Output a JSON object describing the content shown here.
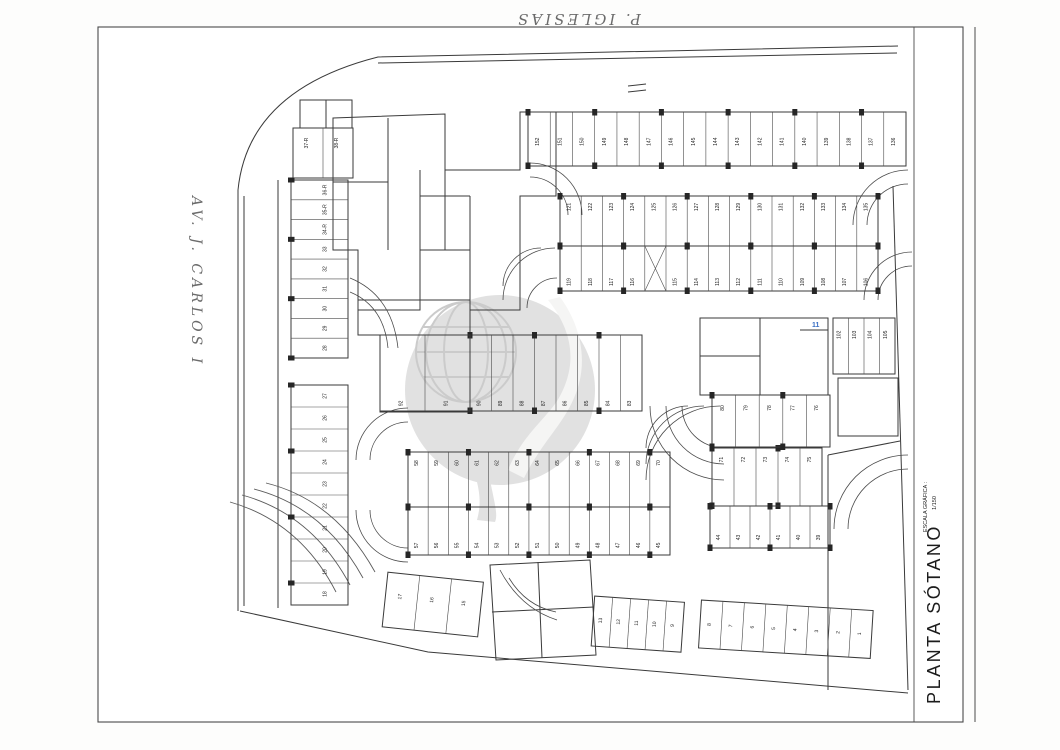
{
  "annotations": {
    "top_street": "P. IGLESIAS",
    "left_street": "AV. J. CARLOS I",
    "blue_note": "11",
    "blue_note_color": "#3a6fc4"
  },
  "title_block": {
    "title": "PLANTA SÓTANO",
    "scale_caption": "ESCALA GRÁFICA :",
    "scale_ratio": "1/150",
    "scale_ticks": [
      "0",
      "1",
      "2",
      "3",
      "4",
      "5m"
    ],
    "scale_end": "10m"
  },
  "watermark": {
    "present": true,
    "style": "globe-swoosh-circle",
    "color": "#d9d9d9"
  },
  "colors": {
    "ink": "#3a3a3a",
    "cyan_hatch": "#63b7cc",
    "pink_marker": "#d4748c",
    "tan": "#c9b896",
    "ramp_fill": "#262626"
  },
  "plan": {
    "rows": [
      {
        "name": "row-136-152",
        "x": 528,
        "y": 112,
        "w": 378,
        "h": 54,
        "numY": 0.55,
        "cols": true,
        "nums": [
          "152",
          "151",
          "150",
          "149",
          "148",
          "147",
          "146",
          "145",
          "144",
          "143",
          "142",
          "141",
          "140",
          "139",
          "138",
          "137",
          "136"
        ]
      },
      {
        "name": "row-121-135",
        "x": 560,
        "y": 196,
        "w": 318,
        "h": 50,
        "numY": 0.22,
        "cols": true,
        "nums": [
          "121",
          "122",
          "123",
          "124",
          "125",
          "126",
          "127",
          "128",
          "129",
          "130",
          "131",
          "132",
          "133",
          "134",
          "135"
        ]
      },
      {
        "name": "row-106-119",
        "x": 560,
        "y": 246,
        "w": 318,
        "h": 45,
        "numY": 0.8,
        "cols": true,
        "nums": [
          "119",
          "118",
          "117",
          "116",
          "X",
          "115",
          "114",
          "113",
          "112",
          "111",
          "110",
          "109",
          "108",
          "107",
          "106"
        ]
      },
      {
        "name": "row-58-70",
        "x": 408,
        "y": 452,
        "w": 262,
        "h": 55,
        "numY": 0.2,
        "cols": true,
        "nums": [
          "58",
          "59",
          "60",
          "61",
          "62",
          "63",
          "64",
          "65",
          "66",
          "67",
          "68",
          "69",
          "70"
        ]
      },
      {
        "name": "row-45-57",
        "x": 408,
        "y": 507,
        "w": 262,
        "h": 48,
        "numY": 0.8,
        "cols": true,
        "nums": [
          "57",
          "56",
          "55",
          "54",
          "53",
          "52",
          "51",
          "50",
          "49",
          "48",
          "47",
          "46",
          "45"
        ]
      },
      {
        "name": "row-71-75",
        "x": 712,
        "y": 448,
        "w": 110,
        "h": 58,
        "numY": 0.2,
        "cols": true,
        "nums": [
          "71",
          "72",
          "73",
          "74",
          "75"
        ]
      },
      {
        "name": "row-39-44",
        "x": 710,
        "y": 506,
        "w": 120,
        "h": 42,
        "numY": 0.75,
        "cols": true,
        "nums": [
          "44",
          "43",
          "42",
          "41",
          "40",
          "39"
        ]
      },
      {
        "name": "row-83-90",
        "x": 470,
        "y": 335,
        "w": 172,
        "h": 76,
        "numY": 0.9,
        "cols": true,
        "nums": [
          "90",
          "89",
          "88",
          "87",
          "86",
          "85",
          "84",
          "83"
        ]
      },
      {
        "name": "row-91-92-pmr",
        "x": 380,
        "y": 335,
        "w": 90,
        "h": 76,
        "numY": 0.9,
        "cols": false,
        "nums": [
          "92",
          "91"
        ]
      },
      {
        "name": "row-76-80",
        "x": 712,
        "y": 395,
        "w": 118,
        "h": 52,
        "numY": 0.25,
        "cols": true,
        "nums": [
          "80",
          "79",
          "78",
          "77",
          "76"
        ]
      },
      {
        "name": "rooms-102-105",
        "x": 833,
        "y": 318,
        "w": 62,
        "h": 56,
        "numY": 0.3,
        "cols": false,
        "nums": [
          "102",
          "103",
          "104",
          "105"
        ]
      },
      {
        "name": "rooms-37R-38R",
        "x": 293,
        "y": 128,
        "w": 60,
        "h": 50,
        "numY": 0.3,
        "cols": false,
        "nums": [
          "37-R",
          "38-R"
        ]
      },
      {
        "name": "col-28-36R",
        "x": 291,
        "y": 180,
        "w": 57,
        "h": 178,
        "vert": true,
        "numX": 0.62,
        "cols": true,
        "nums": [
          "36-R",
          "35-R",
          "34-R",
          "33",
          "32",
          "31",
          "30",
          "29",
          "28"
        ]
      },
      {
        "name": "col-18-27",
        "x": 291,
        "y": 385,
        "w": 57,
        "h": 220,
        "vert": true,
        "numX": 0.62,
        "cols": true,
        "nums": [
          "27",
          "26",
          "25",
          "24",
          "23",
          "22",
          "21",
          "20",
          "19",
          "18"
        ]
      },
      {
        "name": "rooms-15-17",
        "x": 385,
        "y": 572,
        "w": 96,
        "h": 55,
        "numY": 0.42,
        "rot": [
          6,
          385,
          600
        ],
        "nums": [
          "17",
          "16",
          "15"
        ]
      },
      {
        "name": "rooms-9-13",
        "x": 593,
        "y": 596,
        "w": 90,
        "h": 50,
        "numY": 0.48,
        "rot": [
          4,
          593,
          620
        ],
        "nums": [
          "13",
          "12",
          "11",
          "10",
          "9"
        ]
      },
      {
        "name": "rooms-1-8",
        "x": 700,
        "y": 600,
        "w": 172,
        "h": 48,
        "numY": 0.5,
        "rot": [
          3.5,
          700,
          624
        ],
        "nums": [
          "8",
          "7",
          "6",
          "5",
          "4",
          "3",
          "2",
          "1"
        ]
      }
    ],
    "labels": [
      {
        "t": "156",
        "x": 403,
        "y": 140
      },
      {
        "t": "155",
        "x": 403,
        "y": 158
      },
      {
        "t": "154",
        "x": 393,
        "y": 199
      },
      {
        "t": "153",
        "x": 393,
        "y": 215
      },
      {
        "t": "99",
        "x": 408,
        "y": 273
      },
      {
        "t": "82",
        "x": 695,
        "y": 336
      },
      {
        "t": "81",
        "x": 722,
        "y": 383
      },
      {
        "t": "100",
        "x": 715,
        "y": 330
      },
      {
        "t": "101",
        "x": 747,
        "y": 330
      },
      {
        "t": "14",
        "x": 567,
        "y": 593
      }
    ],
    "walls": [
      {
        "d": "M238,190 Q248,90 378,57 L898,46",
        "w": 1.3,
        "n": "site-boundary-top"
      },
      {
        "d": "M893,186 L908,690",
        "w": 1.3,
        "n": "site-boundary-right"
      },
      {
        "d": "M240,611 L428,652 L908,693",
        "w": 1.3,
        "n": "site-boundary-bottom"
      },
      {
        "d": "M238,190 L238,611",
        "w": 1.3,
        "n": "site-boundary-left"
      },
      {
        "d": "M244,196 L244,606",
        "w": 0.7,
        "n": "boundary-inner-left"
      },
      {
        "d": "M378,63 L897,53",
        "w": 0.7,
        "n": "boundary-inner-top"
      },
      {
        "d": "M278,180 L278,608",
        "w": 0.7,
        "n": "sidewalk-line"
      },
      {
        "d": "M333,118 L445,114 L445,170 L520,170 L520,112 L556,112 L556,196 L520,196 L520,310 L470,310 L470,250 L420,250 L420,310 L358,310 L358,250 L333,250 Z",
        "w": 1.2,
        "n": "storage-cluster-outline"
      },
      {
        "d": "M388,118 L388,250",
        "w": 0.8,
        "n": "cluster-wall"
      },
      {
        "d": "M333,182 L388,182",
        "w": 0.8,
        "n": "cluster-wall"
      },
      {
        "d": "M420,170 L420,250",
        "w": 0.8,
        "n": "cluster-wall"
      },
      {
        "d": "M445,170 L445,250",
        "w": 0.8,
        "n": "cluster-wall"
      },
      {
        "d": "M470,196 L470,250",
        "w": 0.8,
        "n": "cluster-wall"
      },
      {
        "d": "M420,196 L470,196",
        "w": 0.8,
        "n": "cluster-wall"
      },
      {
        "d": "M358,300 L470,300 L470,412 L380,412 L380,335 L358,335 Z",
        "w": 1.2,
        "n": "center-core-outline"
      },
      {
        "d": "M358,335 L470,335",
        "w": 0.8,
        "n": "center-core-wall"
      },
      {
        "d": "M700,318 L828,318 L828,395 L700,395 Z",
        "w": 1.2,
        "n": "right-core-outline"
      },
      {
        "d": "M760,318 L760,395",
        "w": 0.8,
        "n": "right-core-wall"
      },
      {
        "d": "M700,356 L760,356",
        "w": 0.8,
        "n": "right-core-wall"
      },
      {
        "d": "M800,330 L828,330",
        "w": 0.8,
        "n": "right-core-wall"
      },
      {
        "d": "M300,100 L352,100 L352,128 L300,128 Z",
        "w": 0.9,
        "n": "top-left-room"
      },
      {
        "d": "M326,100 L326,128",
        "w": 0.7,
        "n": "top-left-room-wall"
      },
      {
        "d": "M628,86 L646,84",
        "w": 0.9,
        "n": "entrance-mark"
      },
      {
        "d": "M628,92 L646,90",
        "w": 0.9,
        "n": "entrance-mark"
      },
      {
        "d": "M828,455 L900,441",
        "w": 1.2,
        "n": "ramp-top-edge"
      },
      {
        "d": "M828,455 L828,690",
        "w": 2.2,
        "n": "ramp-left-wall"
      },
      {
        "d": "M838,378 L898,378 L898,436 L838,436 Z",
        "w": 1,
        "n": "ramp-stair-outline"
      },
      {
        "d": "M490,565 L590,560 L596,655 L496,660 Z",
        "w": 1,
        "n": "bottom-cluster-outline"
      },
      {
        "d": "M538,562 L542,658",
        "w": 0.7,
        "n": "bottom-cluster-wall"
      },
      {
        "d": "M492,612 L594,607",
        "w": 0.7,
        "n": "bottom-cluster-wall"
      }
    ],
    "hatches": [
      {
        "x": 295,
        "y": 132,
        "w": 55,
        "h": 11,
        "dir": "v",
        "gap": 2.5
      },
      {
        "x": 295,
        "y": 166,
        "w": 55,
        "h": 11,
        "dir": "v",
        "gap": 2.5
      },
      {
        "x": 428,
        "y": 124,
        "w": 14,
        "h": 46,
        "dir": "h",
        "gap": 3
      },
      {
        "x": 513,
        "y": 208,
        "w": 20,
        "h": 34,
        "dir": "h",
        "gap": 3.5
      },
      {
        "x": 402,
        "y": 232,
        "w": 56,
        "h": 58,
        "dir": "v",
        "gap": 2.8
      },
      {
        "x": 489,
        "y": 225,
        "w": 24,
        "h": 13,
        "dir": "h",
        "gap": 2.5
      },
      {
        "x": 728,
        "y": 325,
        "w": 15,
        "h": 42,
        "dir": "h",
        "gap": 3
      },
      {
        "x": 765,
        "y": 320,
        "w": 28,
        "h": 20,
        "dir": "v",
        "gap": 2.5
      },
      {
        "x": 838,
        "y": 379,
        "w": 60,
        "h": 56,
        "dir": "h",
        "gap": 2.2
      },
      {
        "x": 452,
        "y": 598,
        "w": 38,
        "h": 16,
        "dir": "v",
        "gap": 2.5
      },
      {
        "x": 488,
        "y": 614,
        "w": 46,
        "h": 16,
        "dir": "v",
        "gap": 2.5
      }
    ],
    "xboxes": [
      [
        645,
        246,
        28,
        45
      ],
      [
        489,
        238,
        24,
        46
      ],
      [
        540,
        375,
        14,
        24
      ],
      [
        503,
        382,
        20,
        18
      ]
    ],
    "grilles": [
      [
        483,
        112,
        17,
        15
      ],
      [
        501,
        112,
        17,
        15
      ],
      [
        483,
        128,
        17,
        15
      ],
      [
        501,
        128,
        17,
        15
      ],
      [
        602,
        113,
        27,
        20
      ],
      [
        631,
        113,
        27,
        20
      ],
      [
        602,
        135,
        27,
        20
      ],
      [
        631,
        135,
        27,
        20
      ]
    ],
    "pinkx": [
      [
        344,
        364,
        12,
        16
      ],
      [
        671,
        279,
        14,
        16
      ]
    ],
    "cyan": [
      [
        422,
        217,
        16,
        16
      ],
      [
        462,
        210,
        9,
        22
      ],
      [
        545,
        338,
        22,
        44
      ],
      [
        521,
        597,
        17,
        16
      ]
    ],
    "tan": [
      [
        493,
        198,
        7,
        26
      ],
      [
        491,
        228,
        10,
        9
      ]
    ],
    "sills": [
      [
        456,
        166,
        14,
        4
      ],
      [
        476,
        199,
        4,
        11
      ],
      [
        520,
        288,
        11,
        4
      ],
      [
        455,
        288,
        4,
        11
      ],
      [
        770,
        326,
        12,
        4
      ],
      [
        826,
        330,
        4,
        11
      ],
      [
        552,
        621,
        24,
        4
      ],
      [
        476,
        646,
        4,
        10
      ],
      [
        700,
        390,
        10,
        4
      ],
      [
        648,
        124,
        28,
        5
      ]
    ],
    "toilets": [
      [
        406,
        209
      ],
      [
        430,
        217
      ],
      [
        499,
        152
      ],
      [
        517,
        152
      ],
      [
        797,
        370
      ],
      [
        516,
        590
      ],
      [
        541,
        592
      ],
      [
        563,
        602
      ]
    ],
    "wheelchairs": [
      [
        318,
        158
      ],
      [
        434,
        275
      ],
      [
        407,
        382
      ],
      [
        449,
        382
      ],
      [
        714,
        346
      ],
      [
        750,
        346
      ]
    ],
    "doors": [
      "M423,190 A14,14 0 0 1 437,176",
      "M473,242 A12,12 0 0 0 485,230",
      "M463,270 A10,10 0 0 1 473,260",
      "M722,348 A13,13 0 0 1 735,335",
      "M800,382 A12,12 0 0 0 812,370",
      "M505,578 A12,12 0 0 1 517,566",
      "M557,650 A13,13 0 0 0 570,637",
      "M310,196 A12,12 0 0 1 322,184",
      "M575,330 A14,14 0 0 1 589,316"
    ],
    "arcs": [
      "M530,163 A52,52 0 0 1 582,215",
      "M530,177 A38,38 0 0 1 568,215",
      "M908,170 A55,55 0 0 0 853,225",
      "M908,184 A41,41 0 0 0 867,225",
      "M555,248 A52,52 0 0 0 503,300",
      "M541,248 A38,38 0 0 0 503,286",
      "M864,300 A48,48 0 0 1 912,252",
      "M878,300 A34,34 0 0 1 912,266",
      "M408,408 A52,52 0 0 0 356,460",
      "M408,422 A38,38 0 0 0 370,460",
      "M356,510 A52,52 0 0 0 408,562",
      "M370,510 A38,38 0 0 0 408,548",
      "M650,406 A74,74 0 0 0 724,480",
      "M666,406 A58,58 0 0 0 724,464",
      "M682,406 A42,42 0 0 0 724,448",
      "M646,480 A74,74 0 0 1 720,406",
      "M646,464 A58,58 0 0 1 704,406",
      "M646,448 A42,42 0 0 1 688,406",
      "M908,455 A74,74 0 0 0 834,529",
      "M908,469 A60,60 0 0 0 848,529",
      "M500,570 Q520,608 557,620",
      "M509,578 Q526,606 556,612",
      "M350,278 Q392,295 398,348",
      "M350,292 Q384,306 388,348",
      "M527,308 A30,30 0 0 1 557,278"
    ],
    "curbs": [
      "M230,502 Q300,522 336,592",
      "M242,495 Q312,514 350,585",
      "M254,489 Q324,507 363,578",
      "M266,483 Q335,500 375,572"
    ],
    "boundary_circles": [
      [
        900,
        46,
        5
      ],
      [
        893,
        186,
        5
      ]
    ],
    "black_ramp": {
      "x": 648,
      "y": 60,
      "w": 28,
      "h": 62
    },
    "ramp_fan": {
      "cx": 908,
      "cy": 693,
      "rmin": 16,
      "rmax": 254,
      "step": 14,
      "clip": [
        829,
        442,
        80,
        250
      ]
    },
    "car": {
      "x": 744,
      "y": 597,
      "w": 40,
      "h": 18,
      "rot": -3
    }
  }
}
